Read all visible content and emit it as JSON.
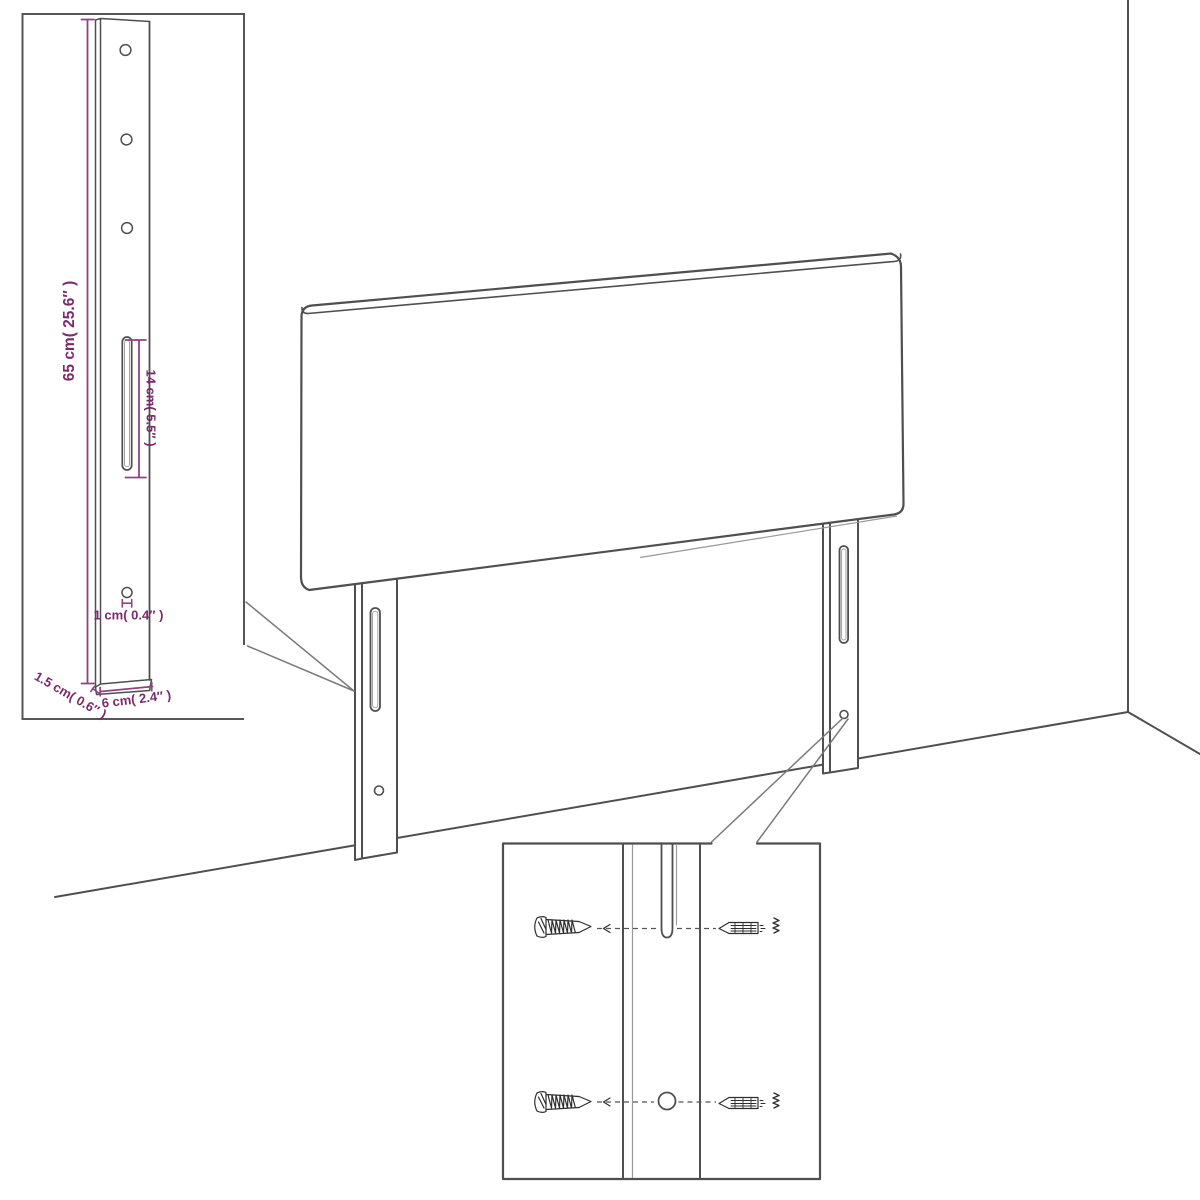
{
  "labels": {
    "leg_height": "65 cm( 25.6″ )",
    "slot_length": "14 cm( 5.5″ )",
    "hole_size": "1 cm( 0.4″ )",
    "leg_depth": "1.5 cm( 0.6″ )",
    "leg_width": "6 cm( 2.4″ )"
  },
  "colors": {
    "accent_text": "#7c2a6d",
    "accent_line": "#8d4580",
    "ink": "#4f4f4f",
    "ink_soft": "#7a7a7a",
    "background": "#ffffff"
  }
}
